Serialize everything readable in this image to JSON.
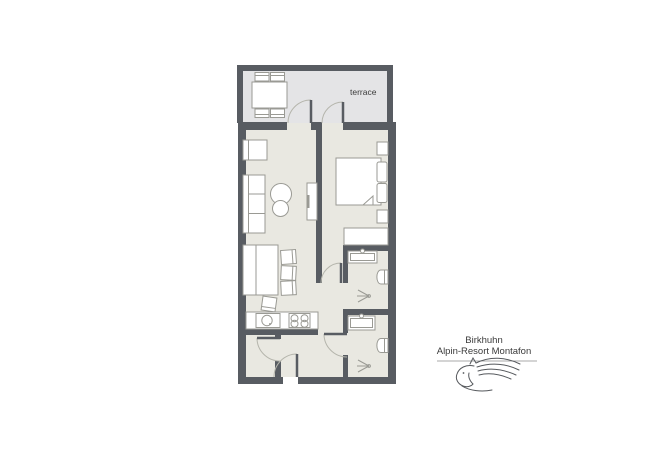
{
  "canvas": {
    "width": 650,
    "height": 450,
    "background": "#ffffff"
  },
  "colors": {
    "wall": "#585c62",
    "terrace_floor": "#e4e4e6",
    "room_floor": "#e9e8e1",
    "furniture_fill": "#ffffff",
    "furniture_stroke": "#9a9a94",
    "door_arc": "#b5b5ac",
    "text": "#3a3a3a",
    "logo_stroke": "#55585c",
    "divider_line": "#8c8c8c"
  },
  "terrace": {
    "label": "terrace"
  },
  "branding": {
    "line1": "Birkhuhn",
    "line2": "Alpin-Resort Montafon",
    "logo": "horse-logo"
  },
  "fixtures": [
    "terrace-dining-table",
    "terrace-chair",
    "armchair",
    "sofa",
    "coffee-table",
    "tv-stand",
    "double-bed",
    "pillow",
    "nightstand",
    "dresser",
    "dining-bench",
    "dining-table",
    "dining-chair",
    "kitchen-counter",
    "kitchen-sink",
    "stove",
    "bathroom-sink",
    "toilet",
    "shower-head-icon",
    "door-swing",
    "wall-segment"
  ]
}
